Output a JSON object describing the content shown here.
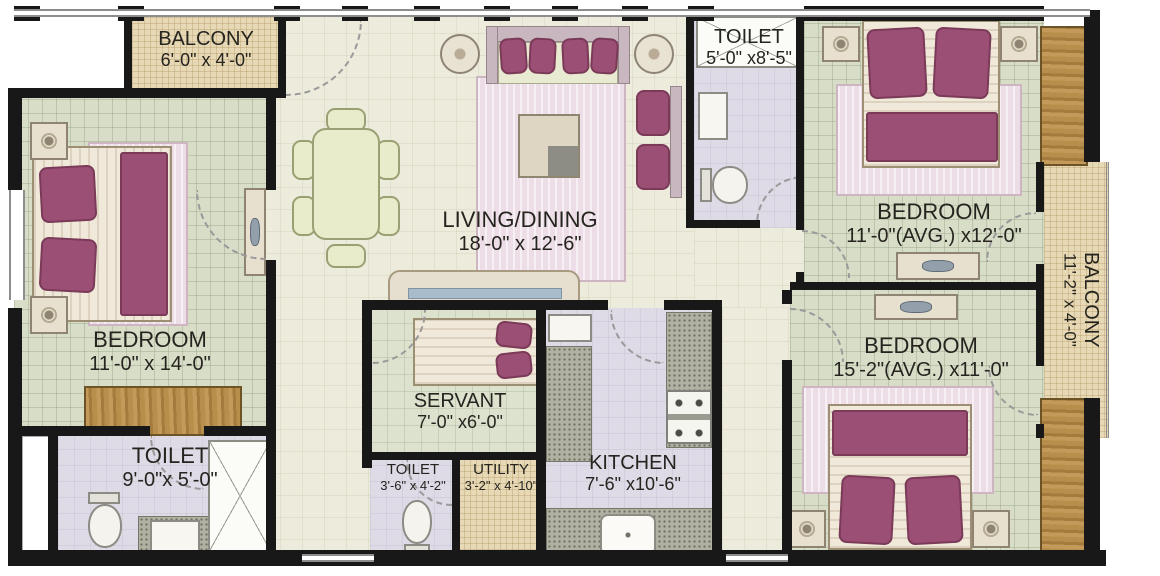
{
  "rooms": {
    "balcony_top": {
      "label": "BALCONY",
      "dims": "6'-0\" x 4'-0\""
    },
    "bedroom_left": {
      "label": "BEDROOM",
      "dims": "11'-0\" x 14'-0\""
    },
    "toilet_left": {
      "label": "TOILET",
      "dims": "9'-0\"x 5'-0\""
    },
    "living_dining": {
      "label": "LIVING/DINING",
      "dims": "18'-0\" x 12'-6\""
    },
    "servant": {
      "label": "SERVANT",
      "dims": "7'-0\" x6'-0\""
    },
    "toilet_small": {
      "label": "TOILET",
      "dims": "3'-6\" x 4'-2\""
    },
    "utility": {
      "label": "UTILITY",
      "dims": "3'-2\" x 4'-10\""
    },
    "kitchen": {
      "label": "KITCHEN",
      "dims": "7'-6\" x10'-6\""
    },
    "toilet_top": {
      "label": "TOILET",
      "dims": "5'-0\" x8'-5\""
    },
    "bedroom_top_right": {
      "label": "BEDROOM",
      "dims": "11'-0\"(AVG.) x12'-0\""
    },
    "balcony_right": {
      "label": "BALCONY",
      "dims": "11'-2\" x 4'-0\""
    },
    "bedroom_bottom_right": {
      "label": "BEDROOM",
      "dims": "15'-2\"(AVG.) x11'-0\""
    }
  },
  "colors": {
    "wall": "#181818",
    "bedroom_floor": "#d8ddc8",
    "living_floor": "#edebdc",
    "balcony_floor": "#e7d9b6",
    "toilet_floor": "#dedae6",
    "accent_maroon": "#9c4f74",
    "wood": "#b78e4c",
    "rug_pink": "#ecdde6"
  }
}
